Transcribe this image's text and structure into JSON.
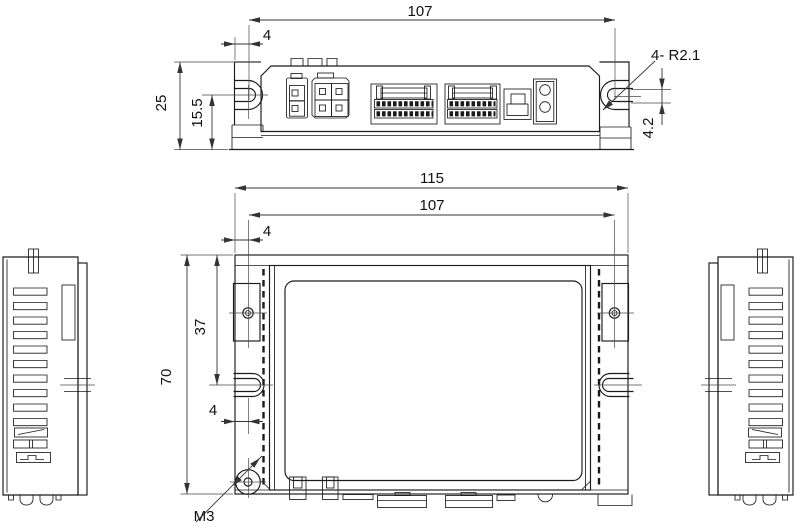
{
  "drawing": {
    "type": "engineering-dimension-drawing",
    "colors": {
      "ink": "#1a1a1a",
      "dimension_lines": "#333333",
      "background": "#ffffff"
    },
    "dimensions": {
      "top_span": "107",
      "top_offset": "4",
      "top_height": "25",
      "top_slot_height": "15.5",
      "corner_radius": "4- R2.1",
      "slot_width": "4.2",
      "overall_width": "115",
      "mount_span": "107",
      "mount_offset": "4",
      "overall_height": "70",
      "hole_drop": "37",
      "bottom_offset": "4",
      "thread": "M3"
    }
  }
}
